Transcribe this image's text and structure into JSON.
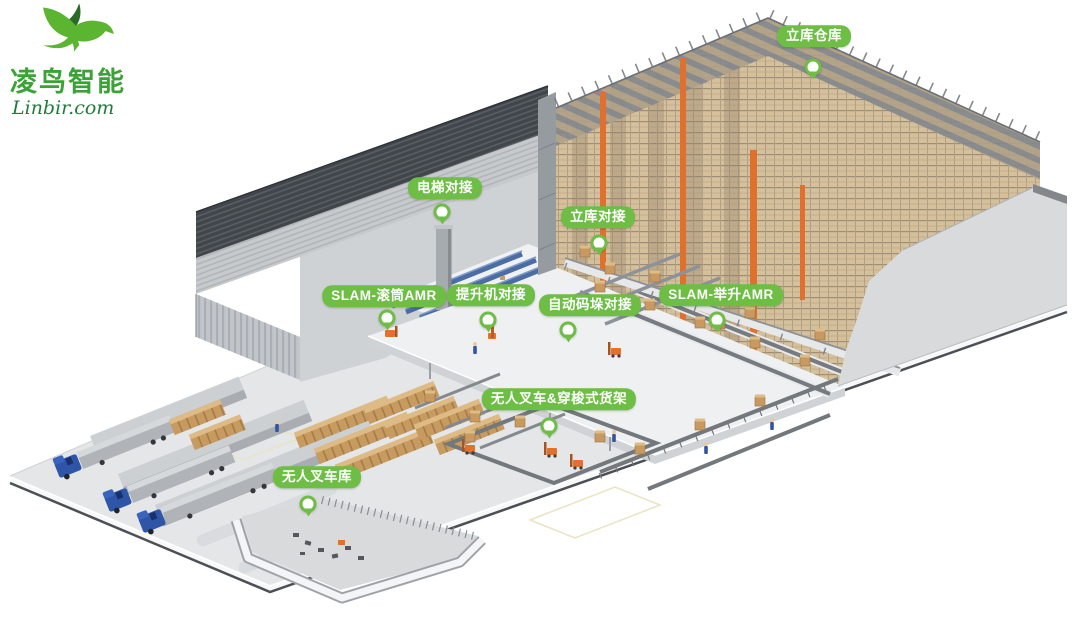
{
  "logo": {
    "company_name": "凌鸟智能",
    "website": "Linbir.com"
  },
  "callouts": [
    {
      "text": "立库仓库"
    },
    {
      "text": "电梯对接"
    },
    {
      "text": "立库对接"
    },
    {
      "text": "SLAM-滚筒AMR"
    },
    {
      "text": "提升机对接"
    },
    {
      "text": "自动码垛对接"
    },
    {
      "text": "SLAM-举升AMR"
    },
    {
      "text": "无人叉车&穿梭式货架"
    },
    {
      "text": "无人叉车库"
    }
  ],
  "colors": {
    "callout_green": "#6ebe45",
    "logo_bird_green": "#5cb531",
    "logo_bird_dark_green": "#2a6b28",
    "logo_text_green": "#3aa335",
    "logo_website_green": "#1f7c3a"
  }
}
